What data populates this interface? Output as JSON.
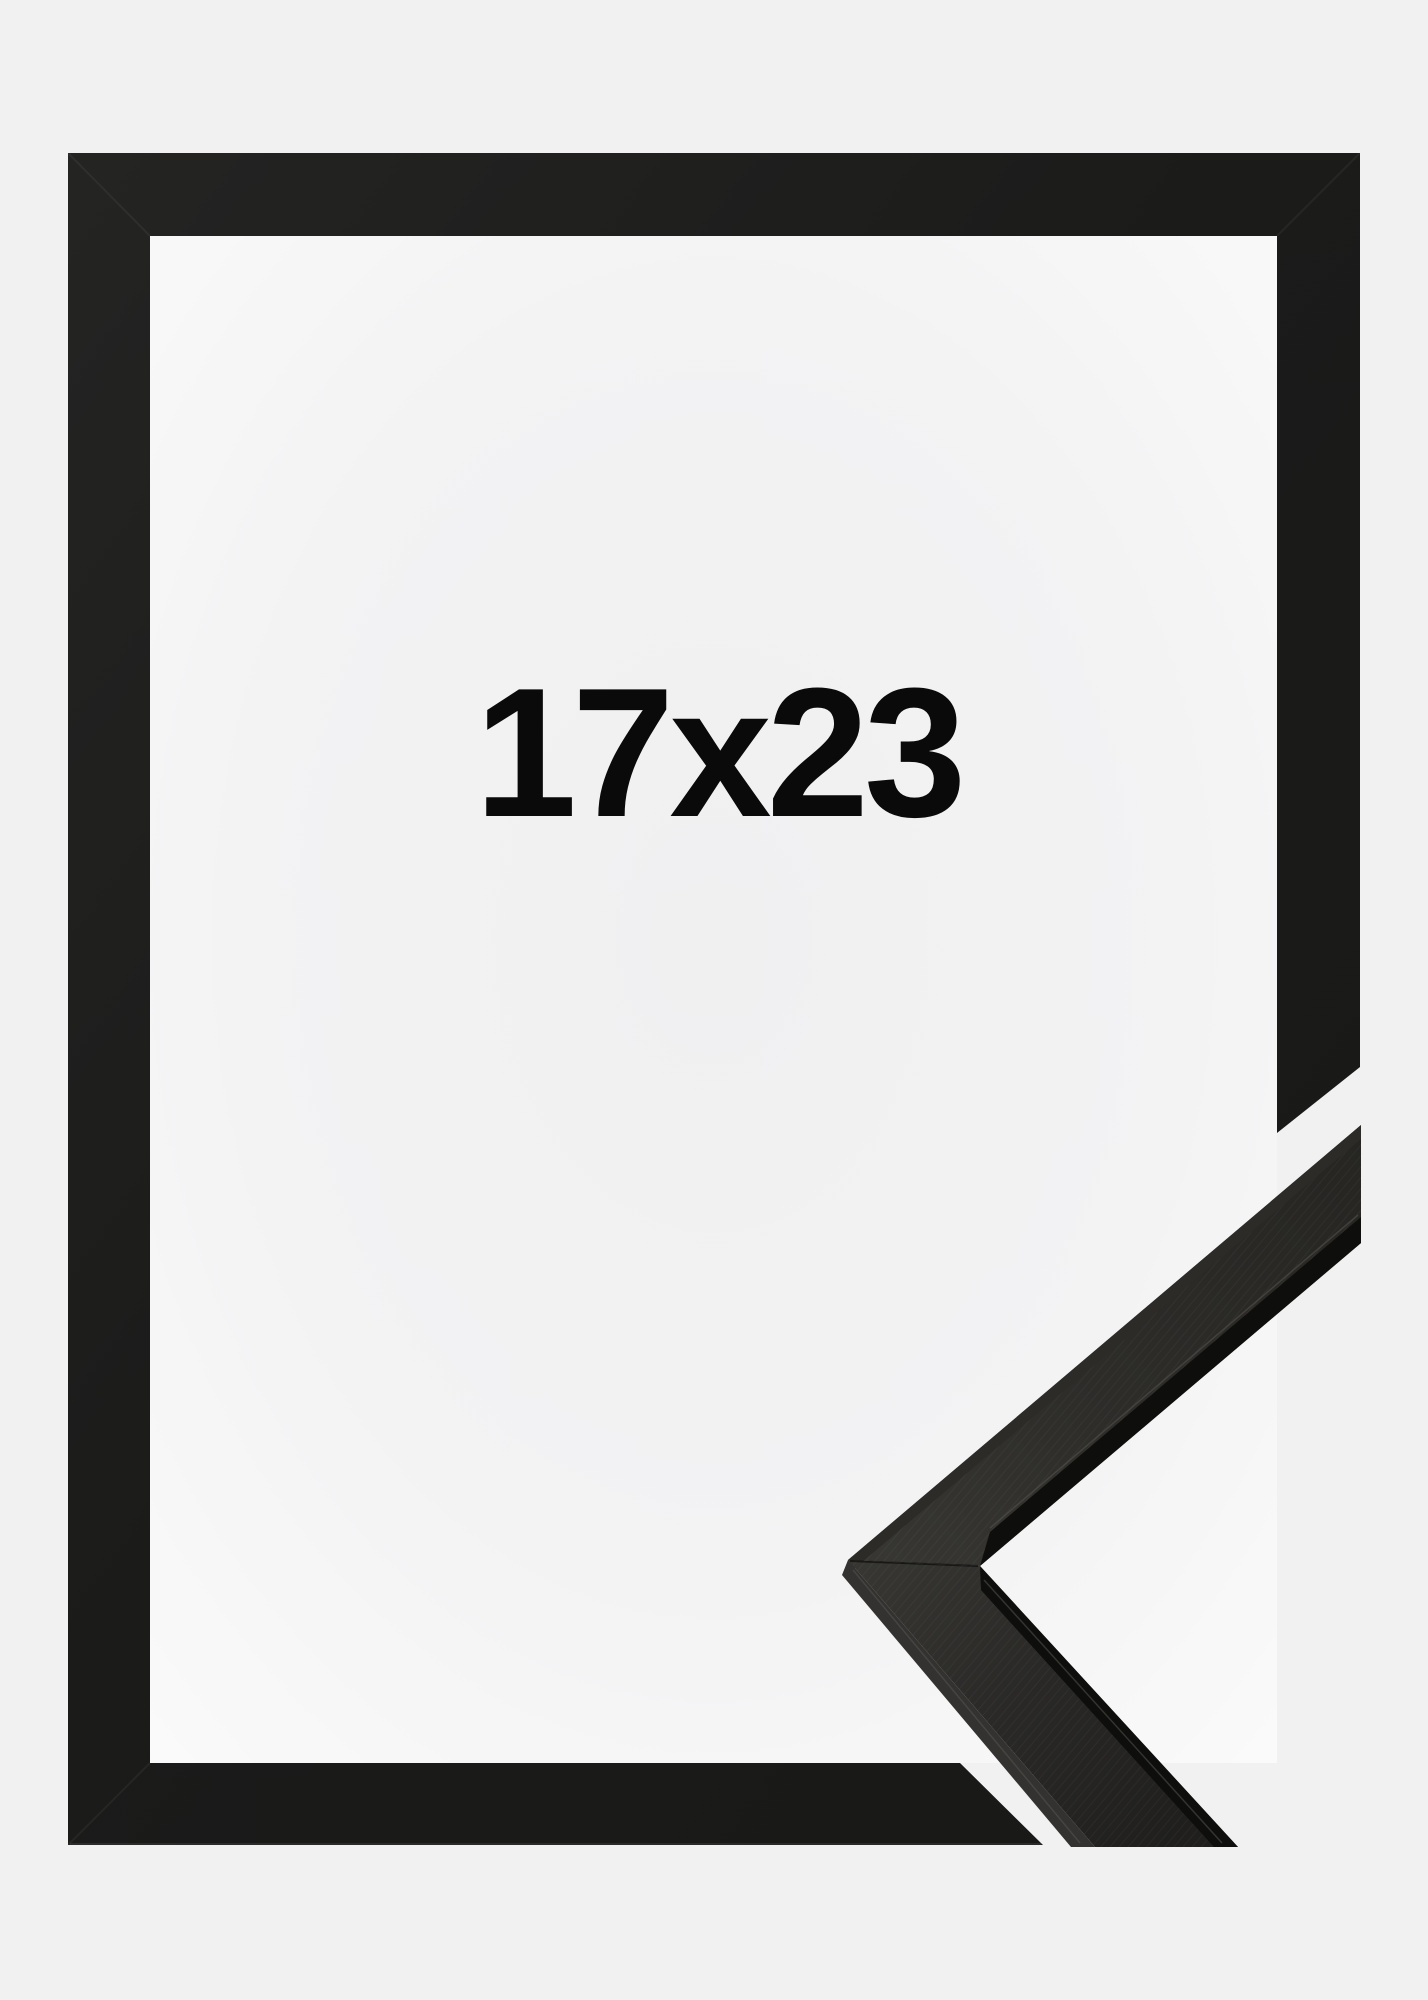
{
  "product": {
    "size_label": "17x23",
    "frame_style": "black-flat-wood-frame",
    "colors": {
      "background": "#f1f1f2",
      "interior": "#f5f5f6",
      "frame": "#1c1c1b",
      "label_text": "#0a0a0a",
      "sample_face": "#2e2d2a",
      "sample_lip": "#0e0e0d"
    }
  }
}
